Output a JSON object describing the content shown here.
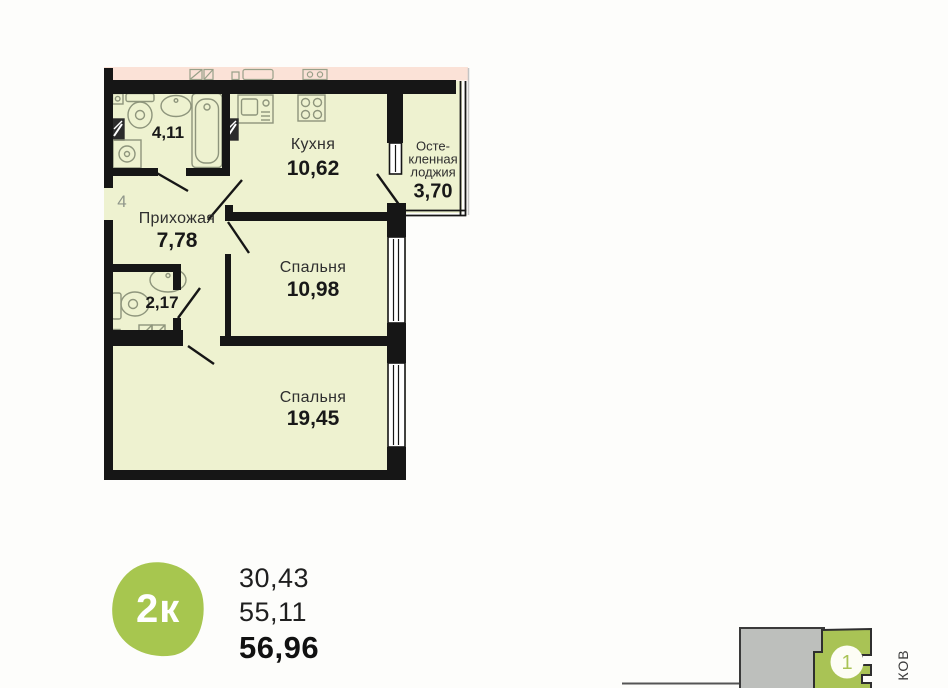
{
  "plan": {
    "floor_number": "4",
    "rooms": {
      "bathroom_main": {
        "area": "4,11"
      },
      "kitchen": {
        "name": "Кухня",
        "area": "10,62"
      },
      "loggia": {
        "name_line1": "Осте-",
        "name_line2": "кленная",
        "name_line3": "лоджия",
        "area": "3,70"
      },
      "hallway": {
        "name": "Прихожая",
        "area": "7,78"
      },
      "bathroom_small": {
        "area": "2,17"
      },
      "bedroom_1": {
        "name": "Спальня",
        "area": "10,98"
      },
      "bedroom_2": {
        "name": "Спальня",
        "area": "19,45"
      }
    }
  },
  "summary": {
    "rooms_badge": "2к",
    "area_line1": "30,43",
    "area_line2": "55,11",
    "area_total": "56,96"
  },
  "site_plan": {
    "building_label": "1",
    "street_text": "КОВ"
  },
  "colors": {
    "accent_green": "#a7c64f",
    "site_green": "#a9c355",
    "plan_room_fill": "#eef2d0",
    "neighbor_fill": "#fbe2d7",
    "wall_black": "#161616"
  }
}
